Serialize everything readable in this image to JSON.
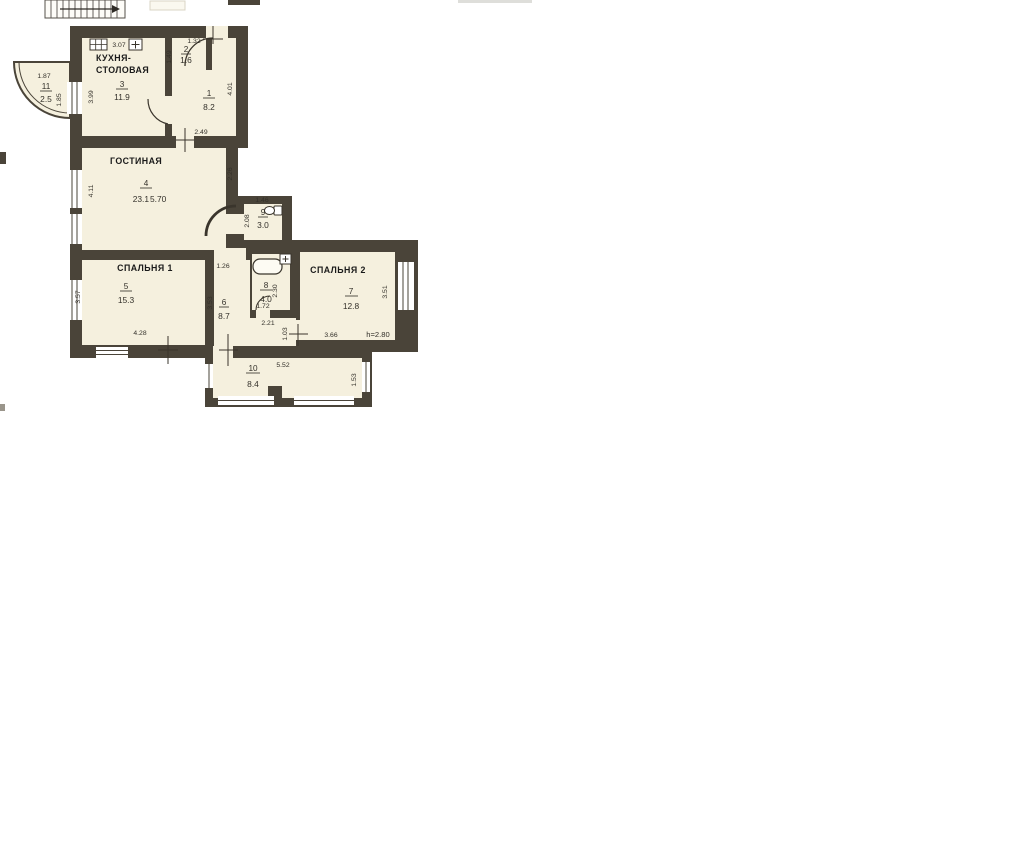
{
  "plan": {
    "type": "apartment floor plan (scanned)",
    "colors": {
      "wall": "#4a4439",
      "floor": "#f5f0de",
      "paper": "#ffffff"
    }
  },
  "rooms": {
    "kitchen": {
      "name_line1": "КУХНЯ-",
      "name_line2": "СТОЛОВАЯ",
      "number": "3",
      "area": "11.9"
    },
    "entry": {
      "number": "2",
      "area": "1.6"
    },
    "room1": {
      "number": "1",
      "area": "8.2"
    },
    "living": {
      "name": "ГОСТИНАЯ",
      "number": "4",
      "area": "23.1",
      "width_note": "5.70"
    },
    "balcony": {
      "number": "11",
      "area": "2.5"
    },
    "wc": {
      "number": "9",
      "area": "3.0"
    },
    "bedroom1": {
      "name": "СПАЛЬНЯ 1",
      "number": "5",
      "area": "15.3"
    },
    "hallway": {
      "number": "6",
      "area": "8.7"
    },
    "bathroom": {
      "number": "8",
      "area": "4.0"
    },
    "bedroom2": {
      "name": "СПАЛЬНЯ 2",
      "number": "7",
      "area": "12.8",
      "height_note": "h=2.80"
    },
    "loggia": {
      "number": "10",
      "area": "8.4"
    }
  },
  "dimensions": {
    "kitchen_top": "3.07",
    "kitchen_left": "3.99",
    "entry_top": "1.32",
    "entry_left": "1.49",
    "room1_right": "4.01",
    "room1_bottom": "2.49",
    "living_left": "4.11",
    "living_right": "2.26",
    "balcony_top": "1.87",
    "balcony_right": "1.85",
    "wc_top": "1.46",
    "wc_left": "2.08",
    "hall_top": "1.26",
    "hall_left": "3.53",
    "bedroom1_left": "3.57",
    "bedroom1_bottom": "4.28",
    "bath_right": "2.30",
    "bath_bottom": "1.72",
    "bath_below": "2.21",
    "corridor_left": "1.03",
    "bedroom2_bottom": "3.66",
    "bedroom2_right": "3.51",
    "loggia_top": "5.52",
    "loggia_right": "1.53"
  }
}
